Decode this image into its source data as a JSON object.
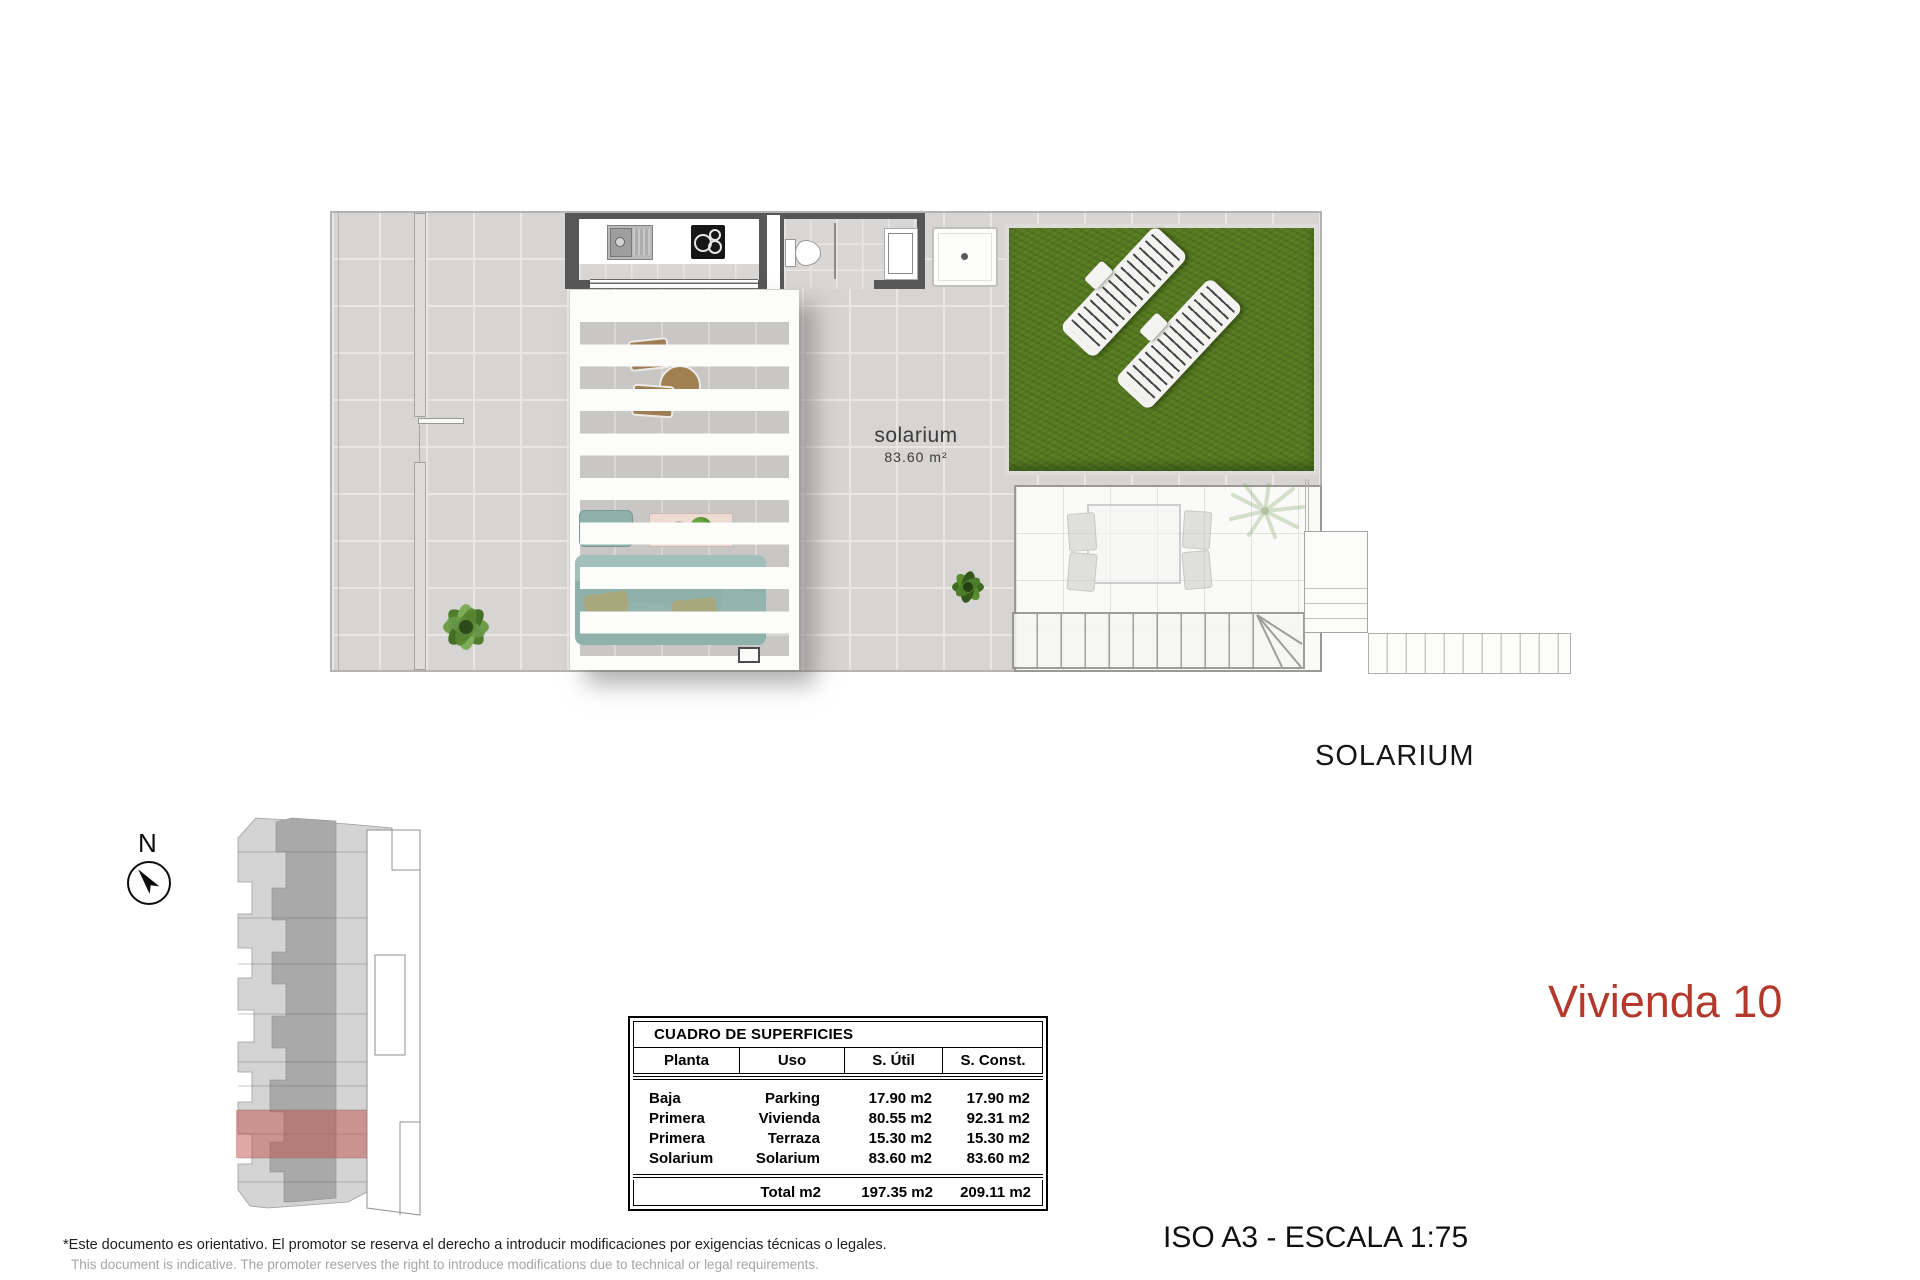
{
  "plan": {
    "room_label": {
      "name": "solarium",
      "area": "83.60  m²"
    }
  },
  "headings": {
    "floor_name": "SOLARIUM"
  },
  "title": {
    "text": "Vivienda 10"
  },
  "scale_note": "ISO A3 - ESCALA 1:75",
  "compass": {
    "label": "N"
  },
  "surface_table": {
    "title": "CUADRO DE SUPERFICIES",
    "headers": [
      "Planta",
      "Uso",
      "S. Útil",
      "S. Const."
    ],
    "rows": [
      {
        "planta": "Baja",
        "uso": "Parking",
        "util": "17.90 m2",
        "constr": "17.90 m2"
      },
      {
        "planta": "Primera",
        "uso": "Vivienda",
        "util": "80.55 m2",
        "constr": "92.31 m2"
      },
      {
        "planta": "Primera",
        "uso": "Terraza",
        "util": "15.30 m2",
        "constr": "15.30 m2"
      },
      {
        "planta": "Solarium",
        "uso": "Solarium",
        "util": "83.60 m2",
        "constr": "83.60 m2"
      }
    ],
    "total": {
      "label": "Total m2",
      "util": "197.35 m2",
      "constr": "209.11 m2"
    }
  },
  "disclaimer": {
    "es": "*Este documento es orientativo. El promotor se reserva el derecho a introducir modificaciones por exigencias técnicas o legales.",
    "en": "This document is indicative. The promoter reserves the right to introduce modifications due to technical or legal requirements."
  },
  "colors": {
    "accent_red": "#b2392c",
    "unit_highlight": "#c1524b",
    "grass_green": "#55791f",
    "wall_dark": "#575757"
  }
}
